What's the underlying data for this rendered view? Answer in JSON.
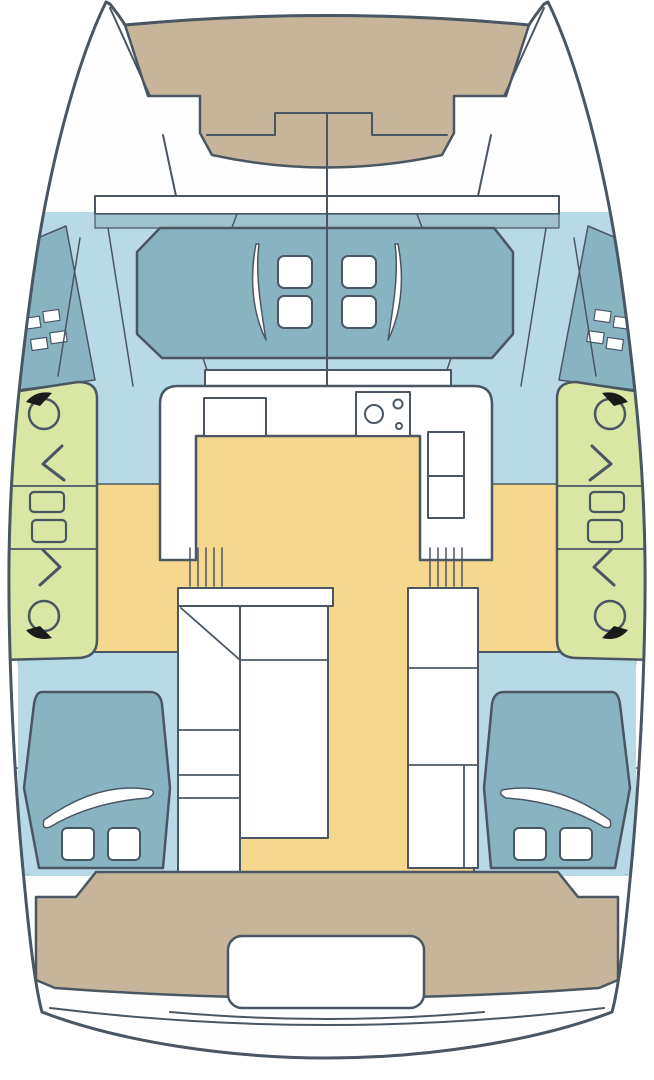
{
  "diagram": {
    "title": "Catamaran deck and interior layout plan (top view)",
    "type": "boat-floor-plan"
  },
  "colors": {
    "background": "#FFFFFF",
    "outline": "#4A5763",
    "hull_white": "#FEFEFE",
    "foredeck_tan": "#C6B59B",
    "deck_blue": "#B7DAE6",
    "band_blue": "#9FC2CD",
    "lounge_teal": "#88B3C1",
    "sidedeck_green": "#D9E6A4",
    "saloon_yellow": "#F6D78E",
    "furniture_white": "#FFFFFF",
    "winch_black": "#1A1A1A"
  },
  "parts": {
    "bows": [
      "port-bow",
      "starboard-bow"
    ],
    "foredeck": "foredeck-trampoline",
    "forward_lounge": {
      "name": "forward-cockpit-lounge",
      "hatches": 4
    },
    "side_decks": {
      "winches": 4,
      "rope_clutches": 4,
      "direction_arrows": 4
    },
    "galley": {
      "items": [
        "sink",
        "stove",
        "refrigerator"
      ]
    },
    "saloon": {
      "stairs": [
        "port-companionway",
        "starboard-companionway"
      ]
    },
    "cabins": [
      {
        "name": "port-aft-cabin",
        "berth": 1,
        "pillows": 2
      },
      {
        "name": "starboard-aft-cabin",
        "berth": 1,
        "pillows": 2
      }
    ],
    "aft": [
      "aft-cockpit-deck",
      "tender-recess",
      "swim-platform"
    ]
  }
}
